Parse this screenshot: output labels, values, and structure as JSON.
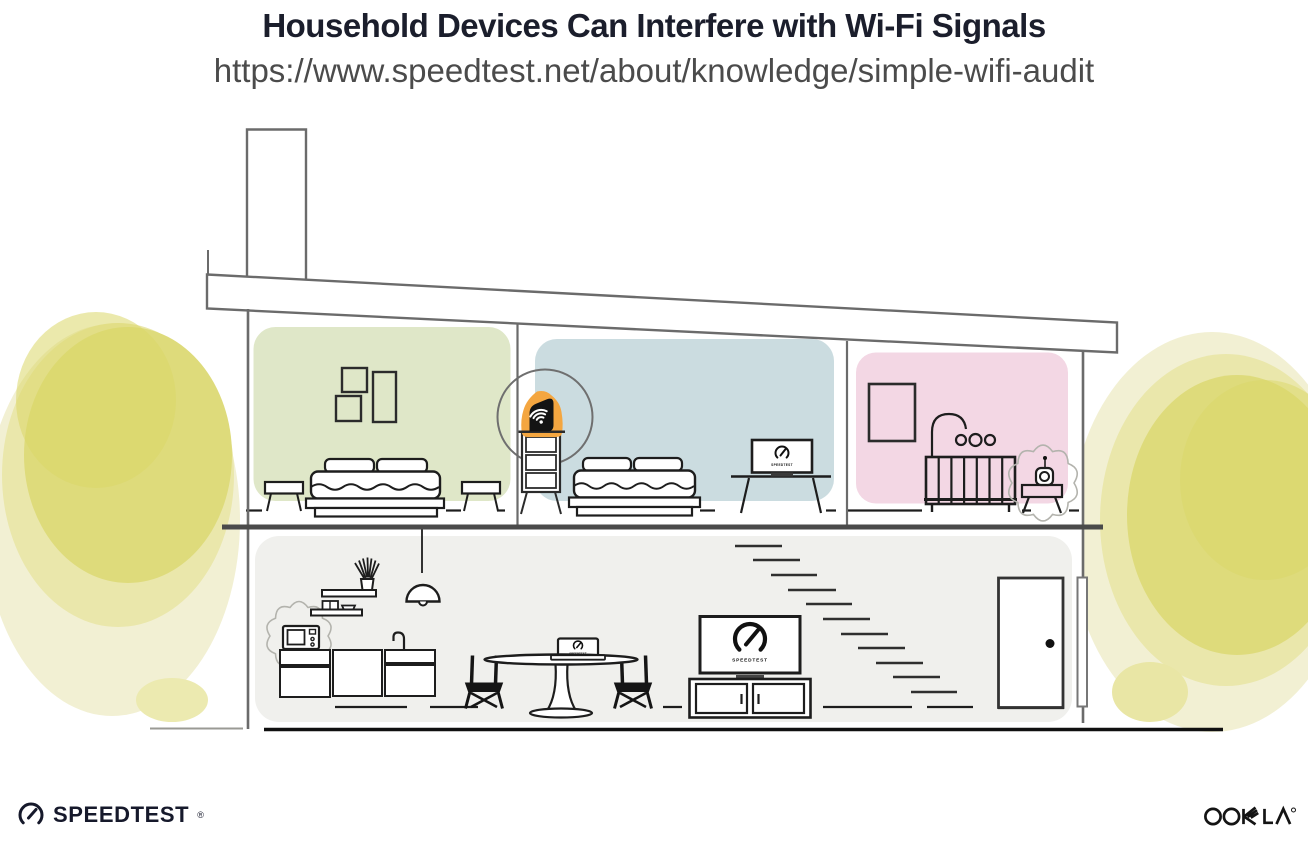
{
  "header": {
    "title": "Household Devices Can Interfere with Wi-Fi Signals",
    "url": "https://www.speedtest.net/about/knowledge/simple-wifi-audit"
  },
  "illustration": {
    "scene": "cutaway-house-two-floors",
    "rooms": [
      {
        "name": "bedroom-left",
        "wall_color": "#dfe7c8"
      },
      {
        "name": "bedroom-middle",
        "wall_color": "#cbdce0"
      },
      {
        "name": "nursery",
        "wall_color": "#f3d7e4"
      },
      {
        "name": "main-floor-living-area",
        "wall_color": "#f0f0ed"
      }
    ],
    "devices": {
      "router": {
        "icon": "wifi-router-icon",
        "highlight_color": "#f4a640"
      },
      "laptop_bedroom": {
        "label": "SPEEDTEST",
        "icon": "speedtest-gauge-icon"
      },
      "laptop_dining": {
        "label": "SPEEDTEST",
        "icon": "speedtest-gauge-icon"
      },
      "tv": {
        "label": "SPEEDTEST",
        "icon": "speedtest-gauge-icon"
      },
      "microwave": {
        "icon": "microwave-icon",
        "interference": true
      },
      "baby_monitor": {
        "icon": "baby-monitor-icon",
        "interference": true
      }
    },
    "foliage_color": "#dedb7b",
    "structure_line_color": "#6b6b6b",
    "furniture_line_color": "#1d1d1d"
  },
  "footer": {
    "speedtest_label": "SPEEDTEST",
    "speedtest_reg": "®",
    "ookla_label": "OOKLA®"
  }
}
